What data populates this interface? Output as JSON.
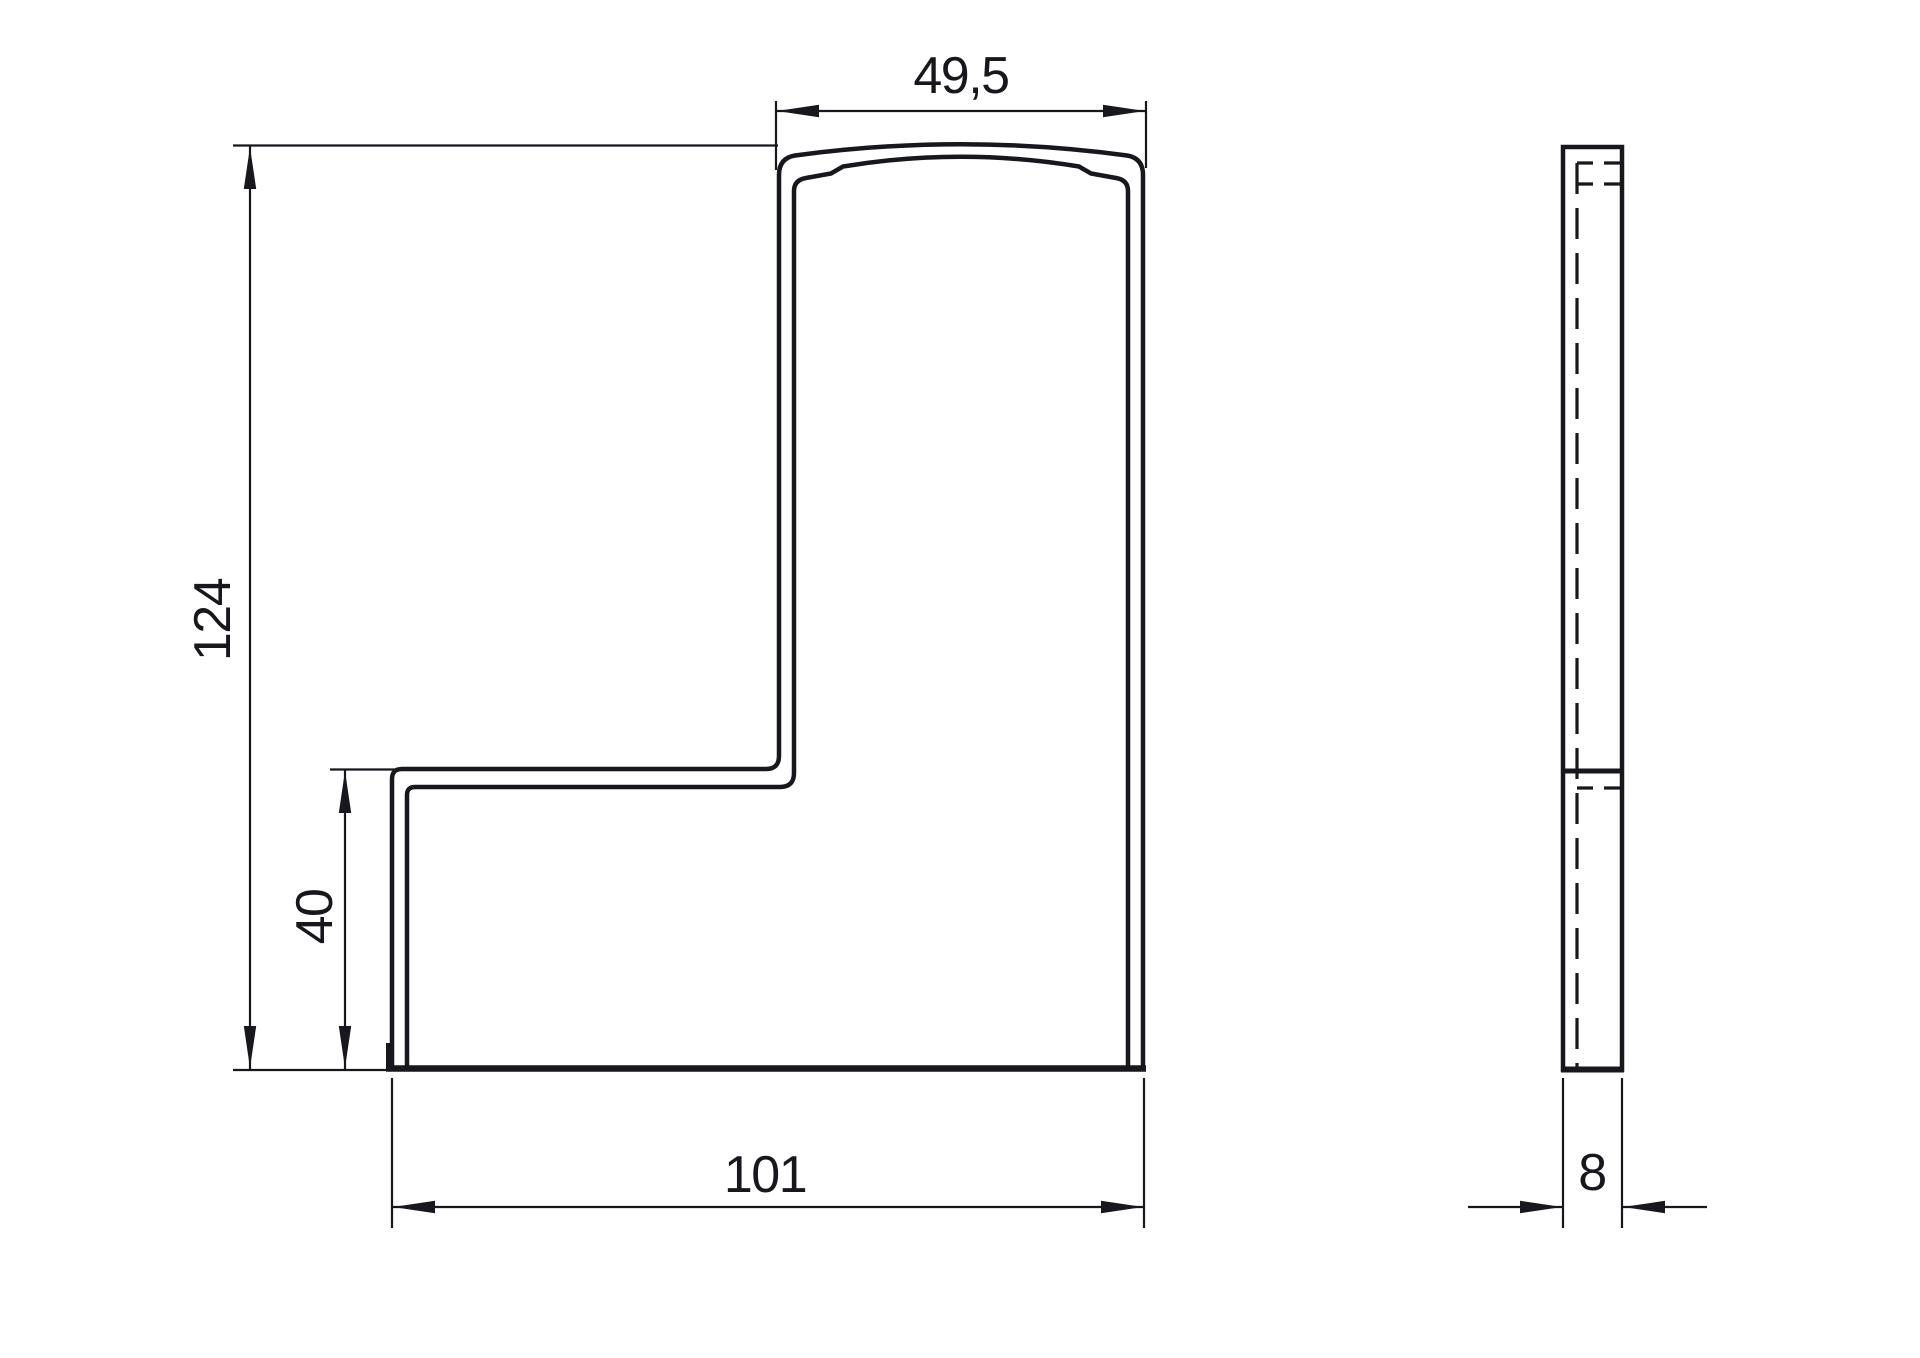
{
  "drawing": {
    "background_color": "#ffffff",
    "line_color": "#17171d",
    "dimensions": {
      "top_width": "49,5",
      "overall_height": "124",
      "step_height": "40",
      "bottom_width": "101",
      "thickness": "8"
    }
  }
}
